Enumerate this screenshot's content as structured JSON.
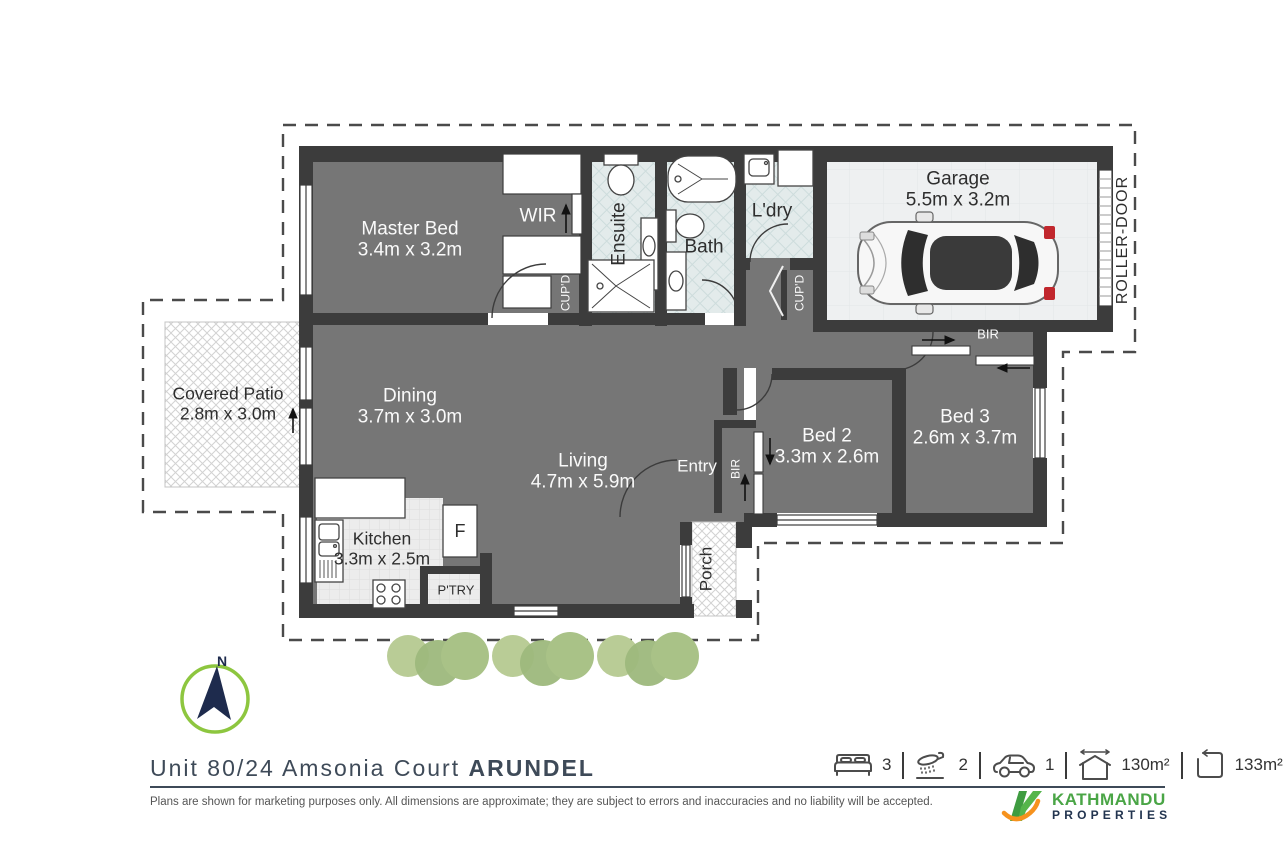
{
  "plan": {
    "rooms": {
      "master": {
        "name": "Master Bed",
        "dims": "3.4m x 3.2m"
      },
      "dining": {
        "name": "Dining",
        "dims": "3.7m x 3.0m"
      },
      "living": {
        "name": "Living",
        "dims": "4.7m x 5.9m"
      },
      "kitchen": {
        "name": "Kitchen",
        "dims": "3.3m x 2.5m"
      },
      "bed2": {
        "name": "Bed 2",
        "dims": "3.3m x 2.6m"
      },
      "bed3": {
        "name": "Bed 3",
        "dims": "2.6m x 3.7m"
      },
      "garage": {
        "name": "Garage",
        "dims": "5.5m x 3.2m"
      },
      "patio": {
        "name": "Covered Patio",
        "dims": "2.8m x 3.0m"
      },
      "ensuite": {
        "name": "Ensuite"
      },
      "bath": {
        "name": "Bath"
      },
      "laundry": {
        "name": "L'dry"
      },
      "entry": {
        "name": "Entry"
      },
      "porch": {
        "name": "Porch"
      },
      "wir": {
        "name": "WIR"
      }
    },
    "annotations": {
      "cupboard1": "CUP'D",
      "cupboard2": "CUP'D",
      "bir_bed2": "BIR",
      "bir_bed3": "BIR",
      "roller_door": "ROLLER-DOOR",
      "pantry": "P'TRY",
      "fridge": "F",
      "north": "N"
    }
  },
  "footer": {
    "address": {
      "street": "Unit 80/24 Amsonia Court",
      "suburb": "ARUNDEL"
    },
    "stats": [
      {
        "icon": "bed-icon",
        "value": "3"
      },
      {
        "icon": "shower-icon",
        "value": "2"
      },
      {
        "icon": "car-icon",
        "value": "1"
      },
      {
        "icon": "house-area-icon",
        "value": "130m²"
      },
      {
        "icon": "land-area-icon",
        "value": "133m²"
      }
    ],
    "disclaimer": "Plans are shown for marketing purposes only. All dimensions are approximate; they are subject to errors and inaccuracies and no liability will be accepted.",
    "brand": {
      "line1": "KATHMANDU",
      "line2": "PROPERTIES"
    }
  },
  "colors": {
    "wall": "#3c3c3c",
    "floor": "#767676",
    "tile": "#e3ebeb",
    "garage_floor": "#eef0f1",
    "accent_green": "#8dc63f",
    "brand_green": "#4aa546",
    "brand_navy": "#22344f",
    "brand_orange": "#f6921e",
    "taillight_red": "#c1272d"
  }
}
